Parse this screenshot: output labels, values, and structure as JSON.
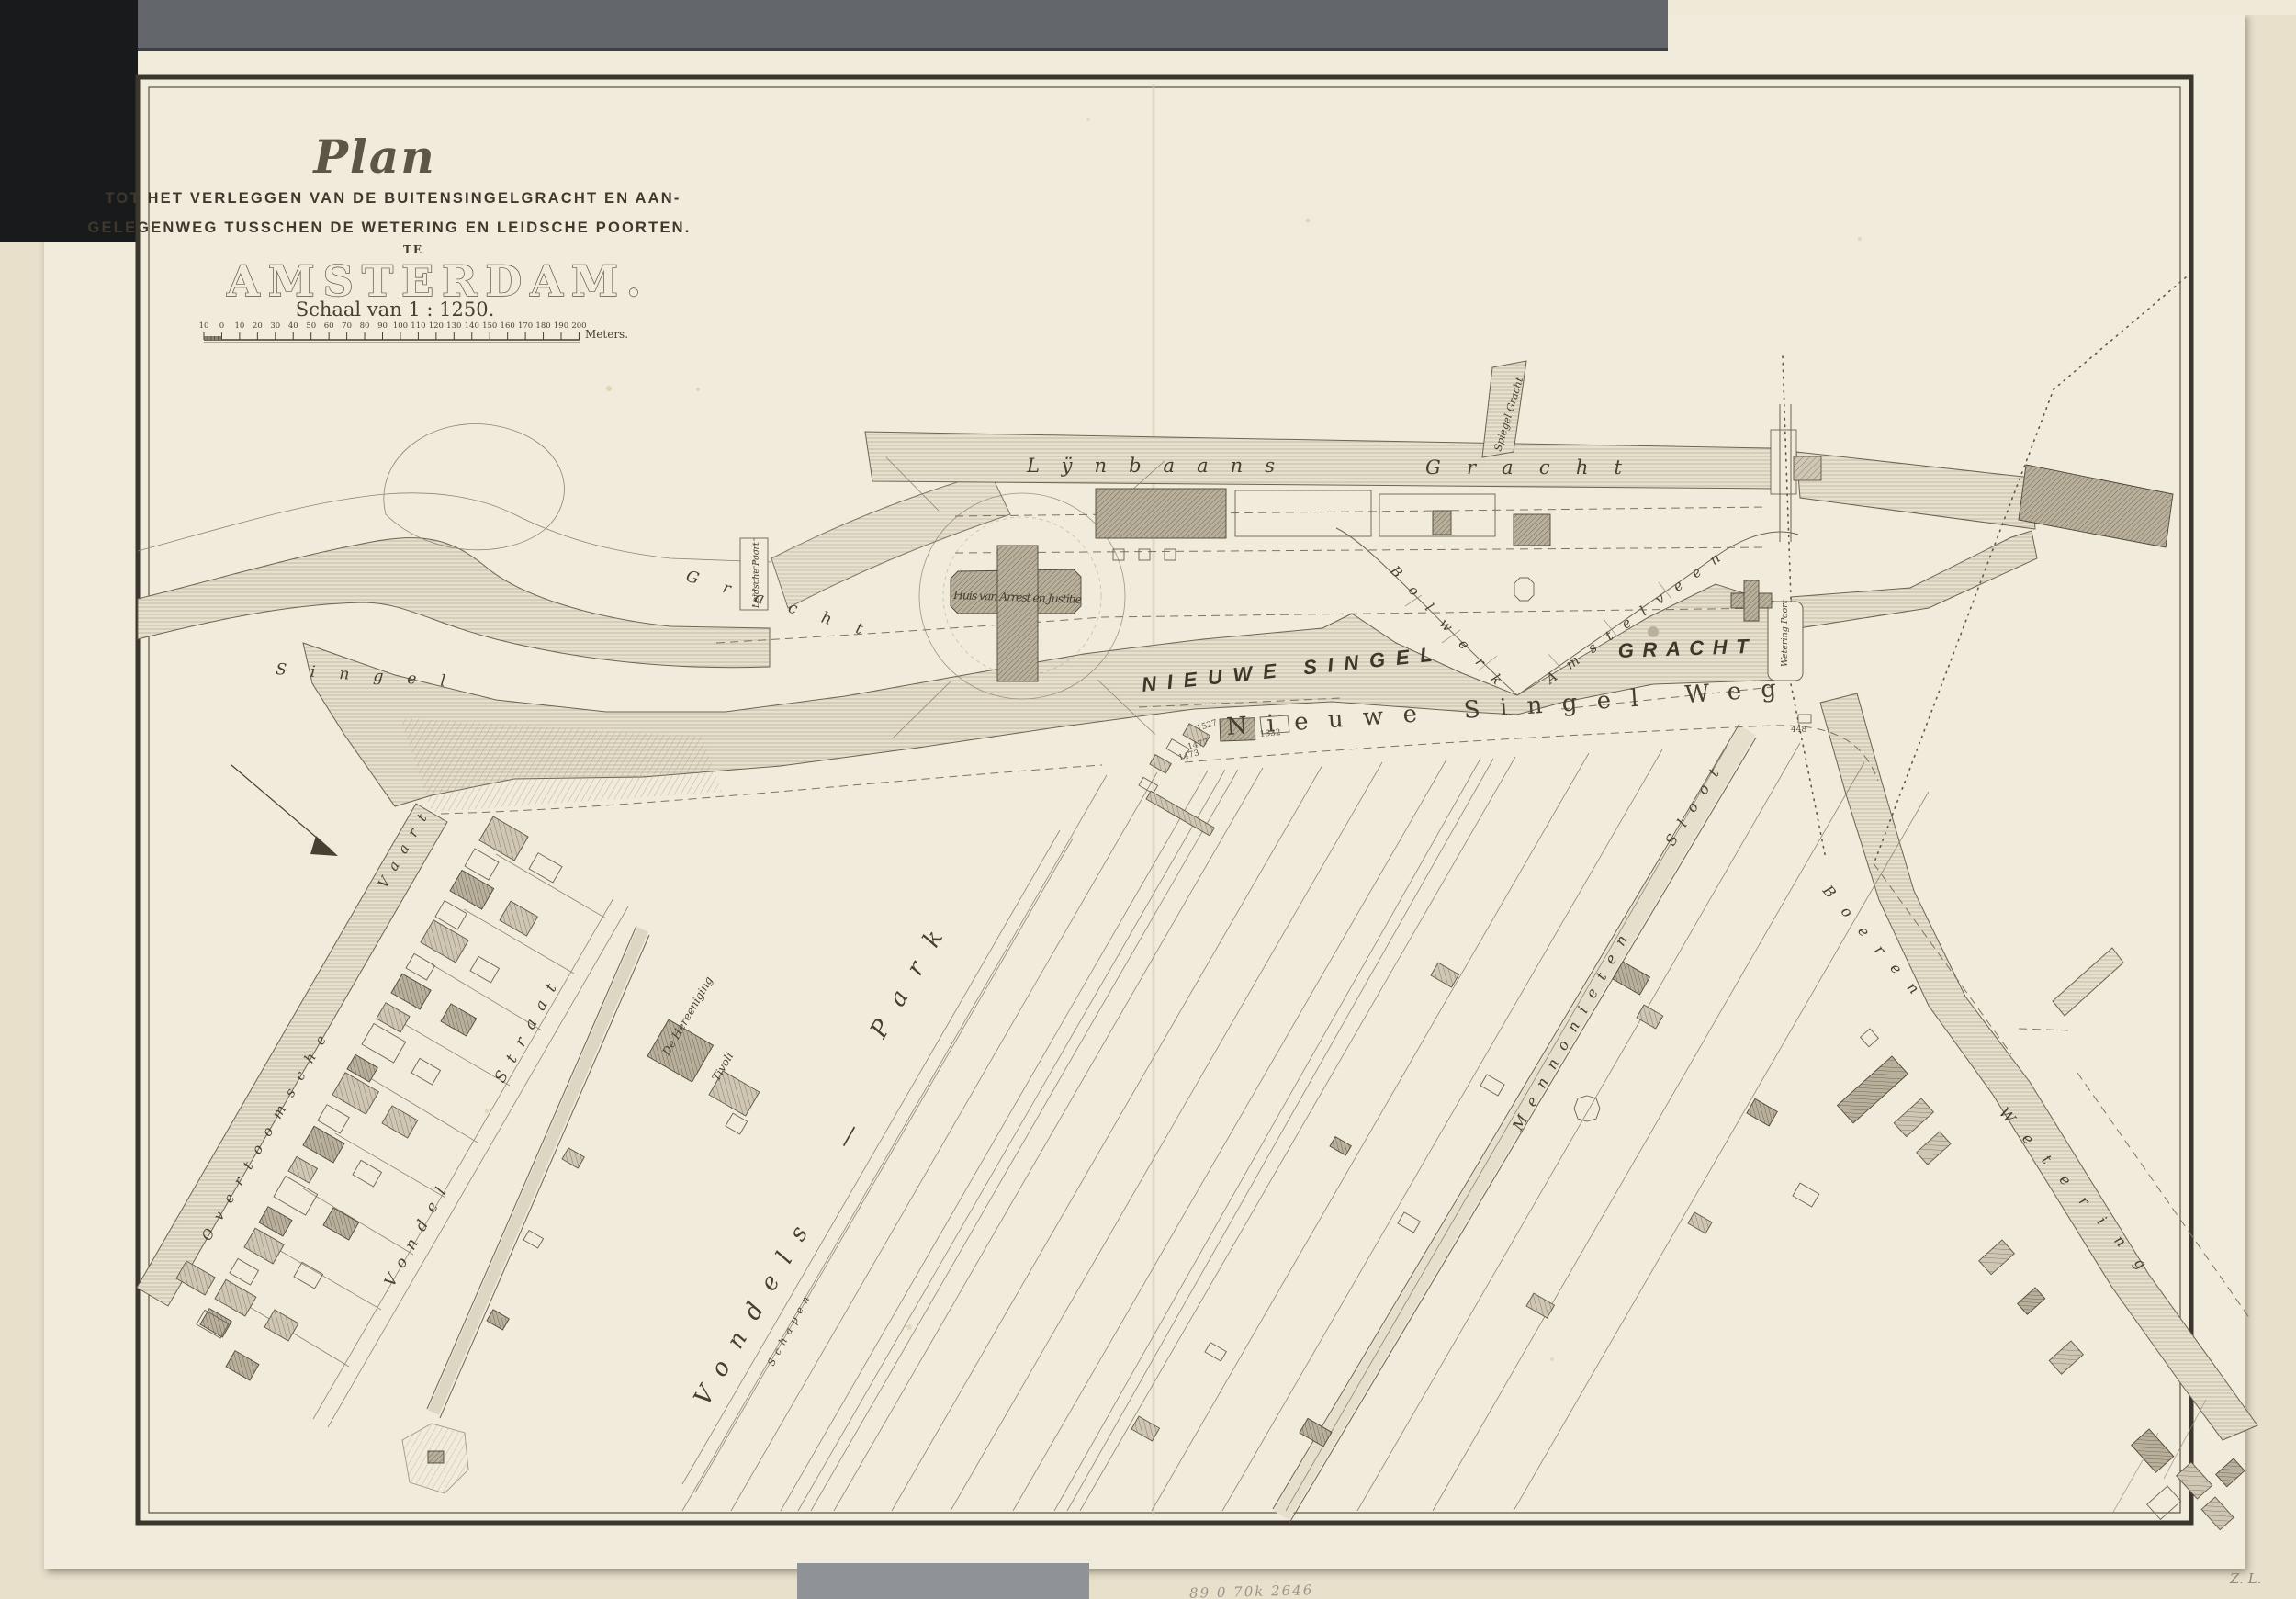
{
  "title_block": {
    "script_title": "Plan",
    "line1": "TOT HET VERLEGGEN VAN DE BUITENSINGELGRACHT EN AAN-",
    "line2": "GELEGENWEG TUSSCHEN DE WETERING EN LEIDSCHE POORTEN.",
    "te": "TE",
    "city": "AMSTERDAM.",
    "scale_caption": "Schaal van 1 : 1250."
  },
  "scale_bar": {
    "tick_labels": [
      "10",
      "0",
      "10",
      "20",
      "30",
      "40",
      "50",
      "60",
      "70",
      "80",
      "90",
      "100",
      "110",
      "120",
      "130",
      "140",
      "150",
      "160",
      "170",
      "180",
      "190",
      "200"
    ],
    "unit": "Meters."
  },
  "labels": {
    "lijnbaans_gracht": {
      "w1": "Lÿnbaans",
      "w2": "Gracht"
    },
    "spiegel_gracht": "Spiegel Gracht",
    "singel": "Singel",
    "gracht_old": "Gracht",
    "leidsche_poort": "Leidsche Poort",
    "wetering_poort": "Wetering Poort",
    "huis_van_arrest": "Huis van Arrest en Justitie",
    "nieuwe_singel_gracht": {
      "w1": "NIEUWE SINGEL",
      "w2": "GRACHT"
    },
    "nieuwe_singel_weg": "Nieuwe Singel Weg",
    "bolwerk_amstelveen": {
      "w1": "Bolwerk",
      "w2": "Amstelveen"
    },
    "overtoomsche_vaart": {
      "w1": "Overtoomsche",
      "w2": "Vaart"
    },
    "vondel_straat": {
      "w1": "Vondel",
      "w2": "Straat"
    },
    "vondels_park": {
      "w1": "Vondels",
      "dash": "—",
      "w2": "Park"
    },
    "hereeniging": "De Hereeniging",
    "tivoli": "Tivoli",
    "schapen": "Schapen",
    "mennonieten_sloot": {
      "w1": "Mennonieten",
      "w2": "Sloot"
    },
    "boeren_wetering": {
      "w1": "Boeren",
      "w2": "Wetering"
    }
  },
  "parcel_numbers": {
    "n1527": "1527",
    "n1532": "1532",
    "n1477": "1477",
    "n1473": "1473",
    "n448": "448"
  },
  "scan": {
    "pencil_note": "89 0 70k 2646",
    "corner_mark": "Z. L."
  },
  "colors": {
    "paper": "#f1ebdb",
    "mount": "#e8e0cb",
    "ink": "#464033",
    "backing_band": "#63666b",
    "backing_black": "#191a1c"
  }
}
